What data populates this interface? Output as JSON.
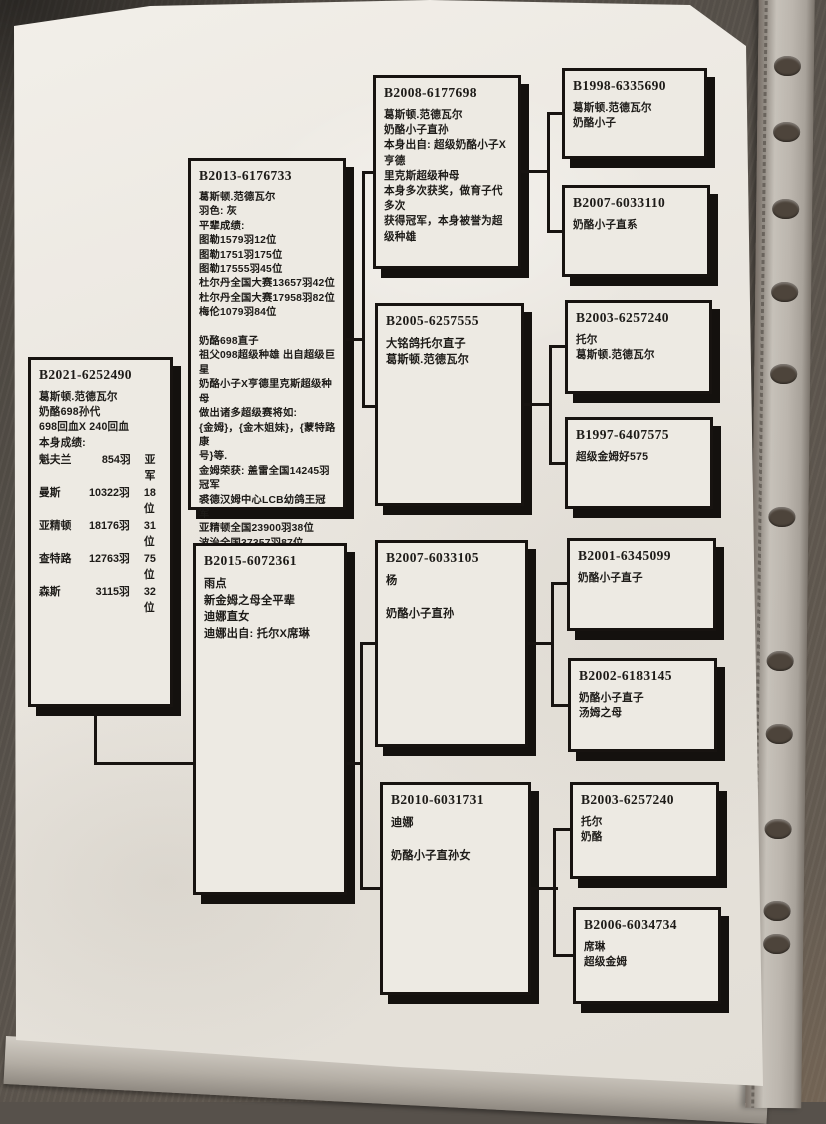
{
  "colors": {
    "ink": "#171310",
    "paper": "#e9e5de",
    "desk": "#57514b"
  },
  "boxes": {
    "b2021": {
      "ring": "B2021-6252490",
      "lines": [
        "葛斯顿.范德瓦尔",
        "奶酪698孙代",
        "698回血X 240回血",
        "本身成绩:"
      ],
      "results": [
        {
          "race": "魁夫兰",
          "birds": "854羽",
          "rank": "亚军"
        },
        {
          "race": "曼斯",
          "birds": "10322羽",
          "rank": "18位"
        },
        {
          "race": "亚精顿",
          "birds": "18176羽",
          "rank": "31位"
        },
        {
          "race": "查特路",
          "birds": "12763羽",
          "rank": "75位"
        },
        {
          "race": "森斯",
          "birds": "3115羽",
          "rank": "32位"
        }
      ]
    },
    "b2013": {
      "ring": "B2013-6176733",
      "lines": [
        "葛斯顿.范德瓦尔",
        "羽色: 灰",
        "平辈成绩:",
        "图勒1579羽12位",
        "图勒1751羽175位",
        "图勒17555羽45位",
        "杜尔丹全国大赛13657羽42位",
        "杜尔丹全国大赛17958羽82位",
        "梅伦1079羽84位",
        "",
        "奶酪698直子",
        "祖父098超级种雄 出自超级巨星",
        "奶酪小子X亨德里克斯超级种母",
        "做出诸多超级赛将如:",
        "{金姆}，{金木姐妹}，{蒙特路康",
        "号}等.",
        "金姆荣获: 盖雷全国14245羽",
        "冠军",
        "裘德汉姆中心LCB幼鸽王冠军",
        "亚精顿全国23900羽38位",
        "波治全国37357羽87位",
        "萨比利斯全省1080羽4位"
      ]
    },
    "b2015": {
      "ring": "B2015-6072361",
      "lines": [
        "雨点",
        "新金姆之母全平辈",
        "迪娜直女",
        "迪娜出自: 托尔X席琳"
      ]
    },
    "b2008": {
      "ring": "B2008-6177698",
      "lines": [
        "葛斯顿.范德瓦尔",
        "奶酪小子直孙",
        "本身出自: 超级奶酪小子X亨德",
        "里克斯超级种母",
        "本身多次获奖，做育子代多次",
        "获得冠军，本身被誉为超级种雄"
      ]
    },
    "b2005": {
      "ring": "B2005-6257555",
      "lines": [
        "大铭鸽托尔直子",
        "葛斯顿.范德瓦尔"
      ]
    },
    "b2007_105": {
      "ring": "B2007-6033105",
      "lines": [
        "杨",
        "",
        "奶酪小子直孙"
      ]
    },
    "b2010": {
      "ring": "B2010-6031731",
      "lines": [
        "迪娜",
        "",
        "奶酪小子直孙女"
      ]
    },
    "b1998": {
      "ring": "B1998-6335690",
      "lines": [
        "葛斯顿.范德瓦尔",
        "奶酪小子"
      ]
    },
    "b2007_110": {
      "ring": "B2007-6033110",
      "lines": [
        "奶酪小子直系"
      ]
    },
    "b2003_top": {
      "ring": "B2003-6257240",
      "lines": [
        "托尔",
        "葛斯顿.范德瓦尔"
      ]
    },
    "b1997": {
      "ring": "B1997-6407575",
      "lines": [
        "超级金姆好575"
      ]
    },
    "b2001": {
      "ring": "B2001-6345099",
      "lines": [
        "奶酪小子直子"
      ]
    },
    "b2002": {
      "ring": "B2002-6183145",
      "lines": [
        "奶酪小子直子",
        "汤姆之母"
      ]
    },
    "b2003_bottom": {
      "ring": "B2003-6257240",
      "lines": [
        "托尔",
        "奶酪"
      ]
    },
    "b2006": {
      "ring": "B2006-6034734",
      "lines": [
        "席琳",
        "超级金姆"
      ]
    }
  }
}
